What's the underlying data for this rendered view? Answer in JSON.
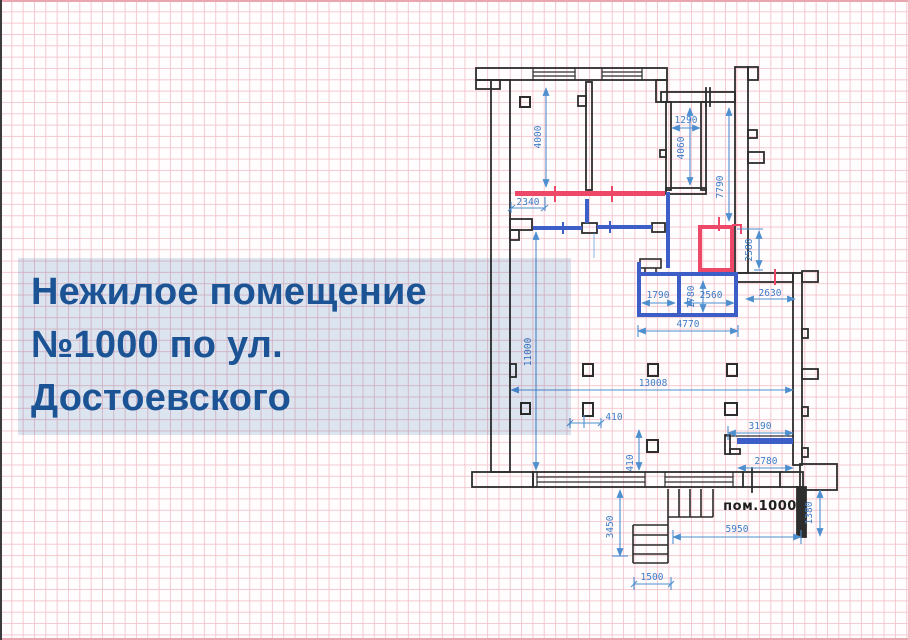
{
  "title": {
    "line1": "Нежилое помещение",
    "line2": "№1000 по ул.",
    "line3": "Достоевского",
    "text_color": "#1b5394",
    "panel_color": "#dce6f2"
  },
  "plan": {
    "room_label": "пом.1000",
    "colors": {
      "existing_walls": "#2d2d2d",
      "new_partitions_blue": "#3c5ec6",
      "demolished_red": "#ee4868",
      "dimension_lines": "#4e8fd0",
      "dimension_text": "#3e7bc7"
    },
    "dims": {
      "d4000": "4000",
      "d2340": "2340",
      "d1290": "1290",
      "d4060": "4060",
      "d7790": "7790",
      "d2580": "2580",
      "d1790": "1790",
      "d1780": "1780",
      "d2560": "2560",
      "d2630": "2630",
      "d4770": "4770",
      "d11000": "11000",
      "d13008": "13008",
      "d410": "410",
      "d3190": "3190",
      "d2780": "2780",
      "d3450": "3450",
      "d1500": "1500",
      "d5950": "5950",
      "d1380": "1380"
    }
  }
}
